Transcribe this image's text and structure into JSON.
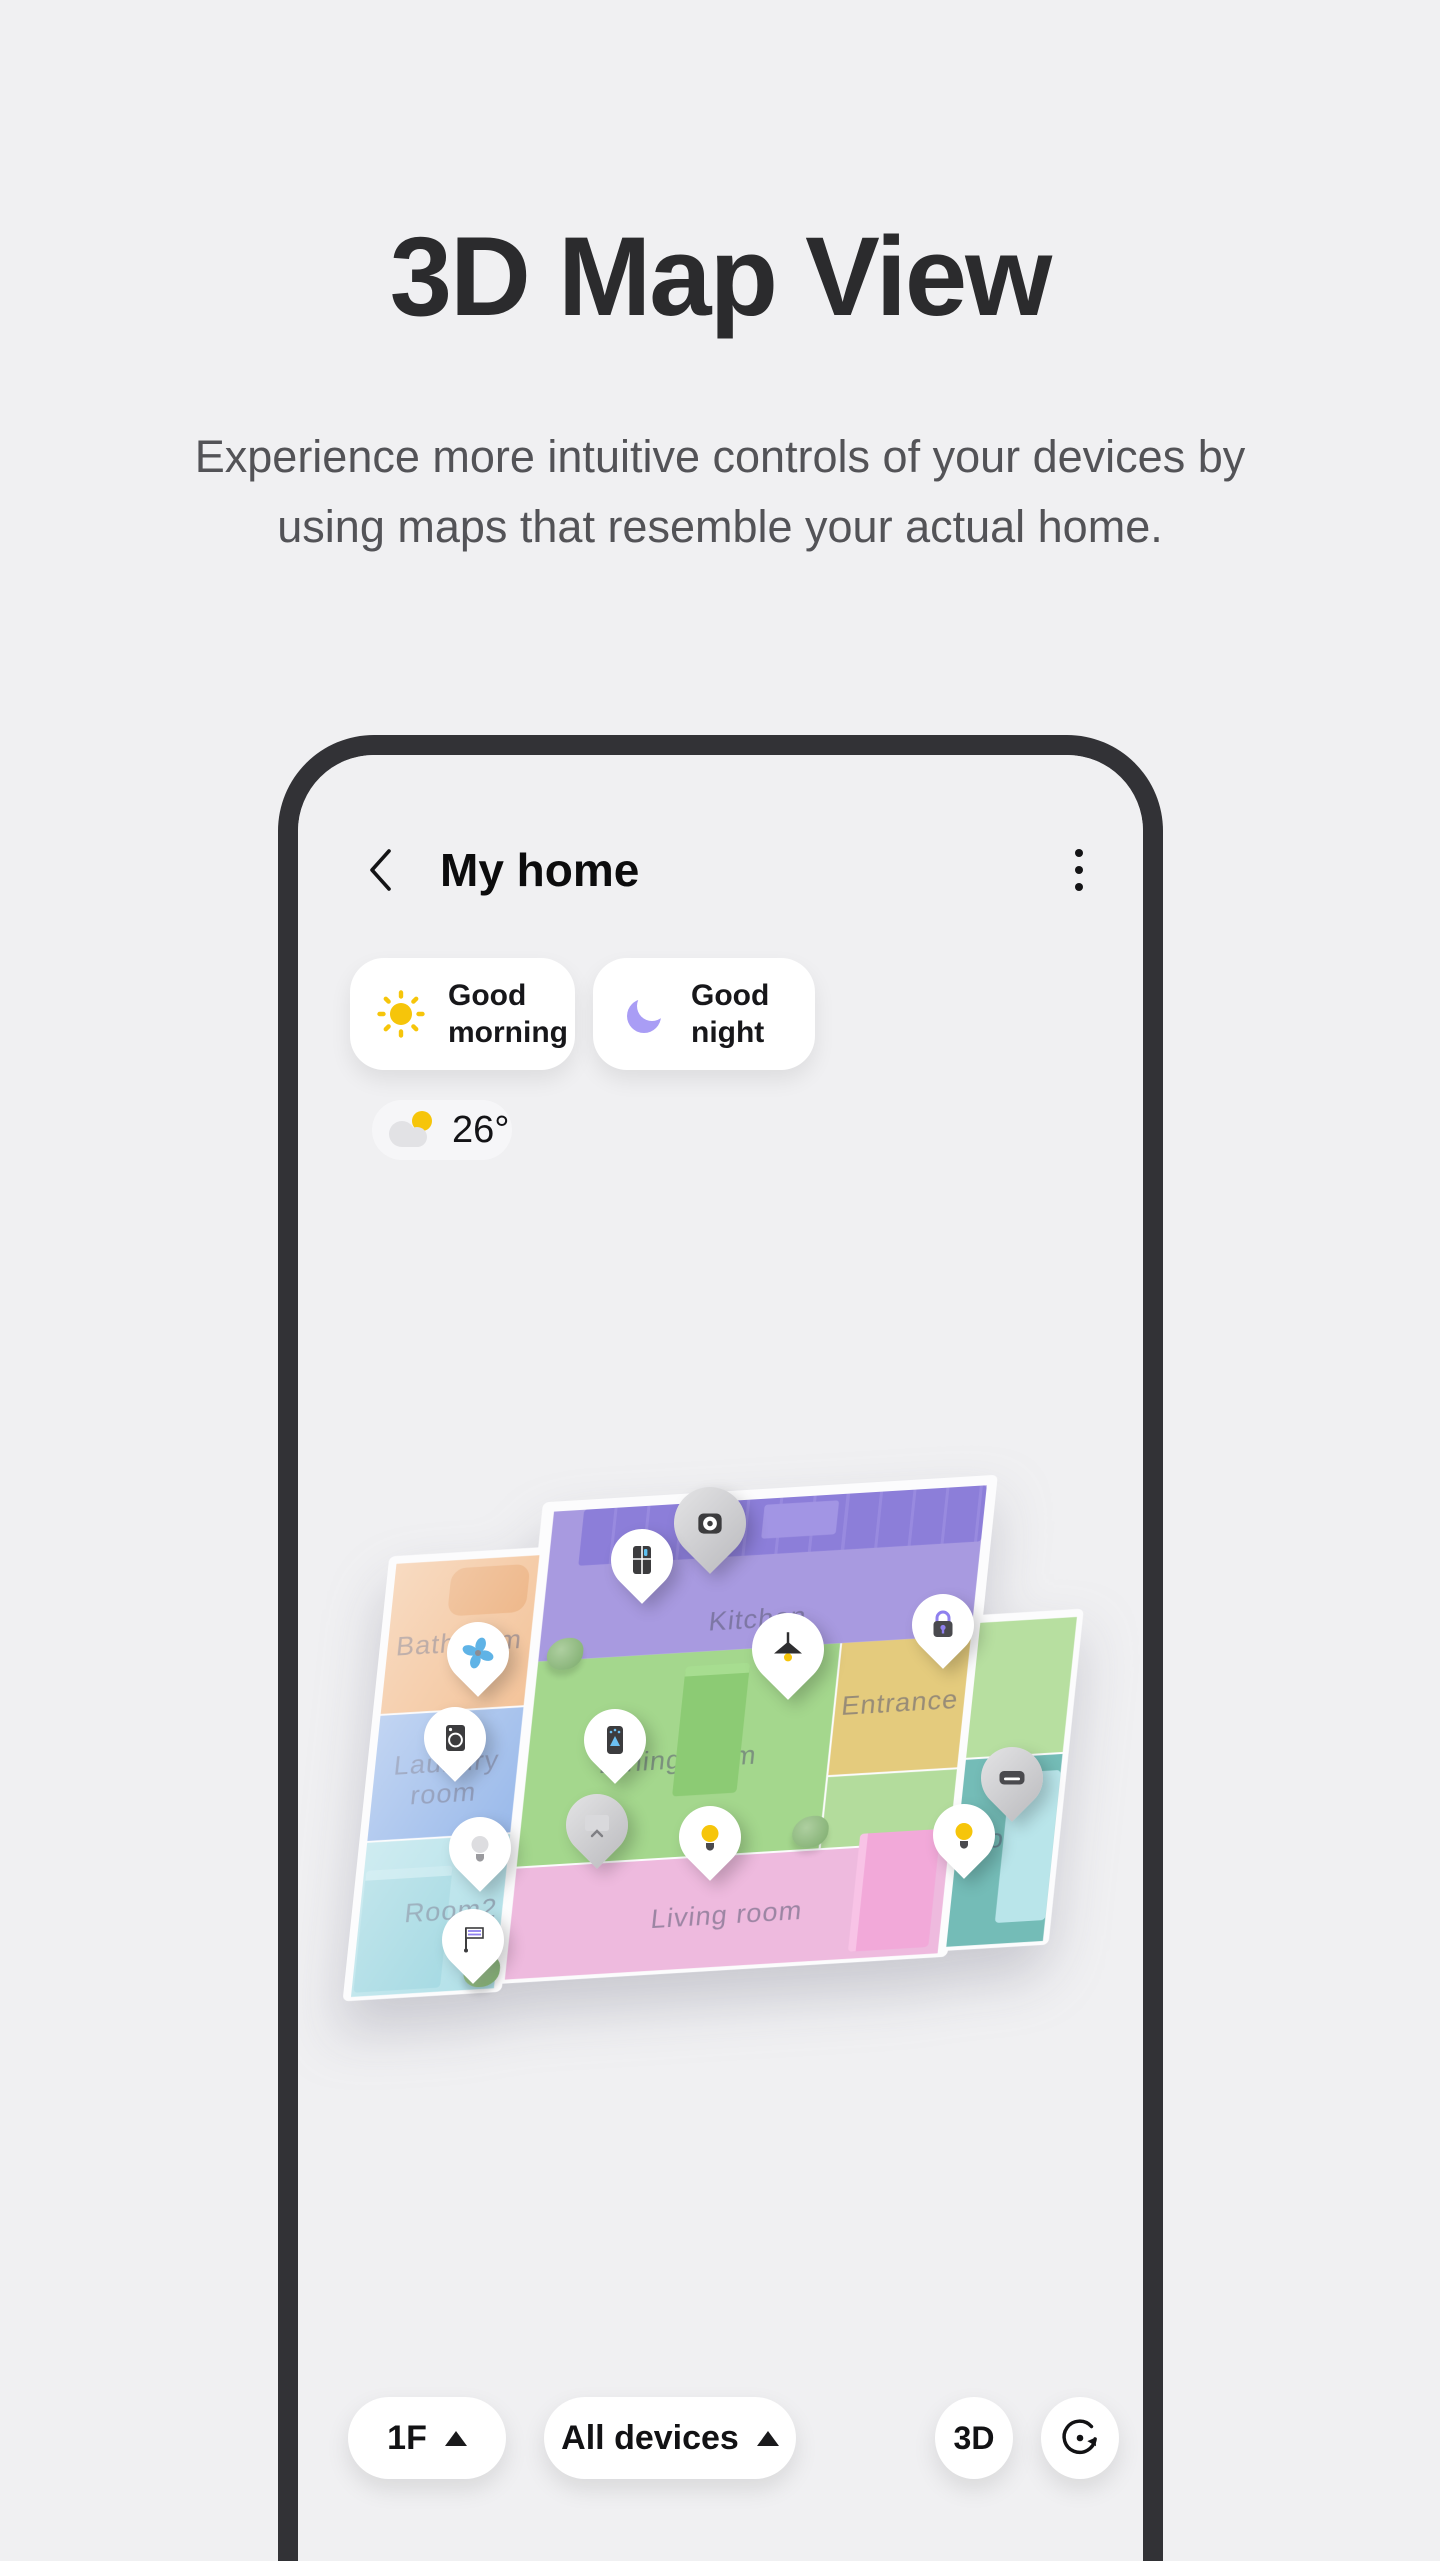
{
  "page": {
    "title": "3D Map View",
    "subtitle": "Experience more intuitive controls of your devices by using maps that resemble your actual home."
  },
  "phone": {
    "header": {
      "title": "My home",
      "back_icon": "chevron-left-icon",
      "menu_icon": "kebab-menu-icon"
    },
    "scenes": [
      {
        "label": "Good morning",
        "icon": "sun-icon",
        "icon_color": "#F6C50A"
      },
      {
        "label": "Good night",
        "icon": "moon-icon",
        "icon_color": "#A99DF5"
      }
    ],
    "weather": {
      "temperature": "26°",
      "icon": "partly-cloudy-icon"
    },
    "map": {
      "rooms": [
        {
          "name": "Kitchen",
          "color": "#a89ae0"
        },
        {
          "name": "Dining room",
          "color": "#a4d78d"
        },
        {
          "name": "Entrance",
          "color": "#e4cb7d"
        },
        {
          "name": "Living room",
          "color": "#eebade"
        },
        {
          "name": "Room",
          "color": "#74bcb7"
        },
        {
          "name": "Bathroom",
          "color": "#f2bd8f"
        },
        {
          "name": "Laundry room",
          "color": "#8fb2e8"
        },
        {
          "name": "Room2",
          "color": "#a7dce5"
        }
      ],
      "pins": [
        {
          "icon": "camera-icon",
          "room": "Kitchen"
        },
        {
          "icon": "refrigerator-icon",
          "room": "Kitchen"
        },
        {
          "icon": "fan-icon",
          "room": "Bathroom"
        },
        {
          "icon": "washer-icon",
          "room": "Laundry room"
        },
        {
          "icon": "air-purifier-icon",
          "room": "Dining room"
        },
        {
          "icon": "pendant-light-icon",
          "room": "Dining room"
        },
        {
          "icon": "smart-lock-icon",
          "room": "Entrance"
        },
        {
          "icon": "tv-icon",
          "room": "Living room"
        },
        {
          "icon": "bulb-on-icon",
          "room": "Living room"
        },
        {
          "icon": "bulb-off-icon",
          "room": "Room2"
        },
        {
          "icon": "flag-sensor-icon",
          "room": "Room2"
        },
        {
          "icon": "bulb-on-icon",
          "room": "Room"
        },
        {
          "icon": "air-conditioner-icon",
          "room": "Room"
        }
      ]
    },
    "controls": {
      "floor": "1F",
      "devices_filter": "All devices",
      "view_mode": "3D",
      "rotate_icon": "rotate-view-icon"
    },
    "frame_color": "#323236",
    "background_color": "#F0F0F2"
  }
}
